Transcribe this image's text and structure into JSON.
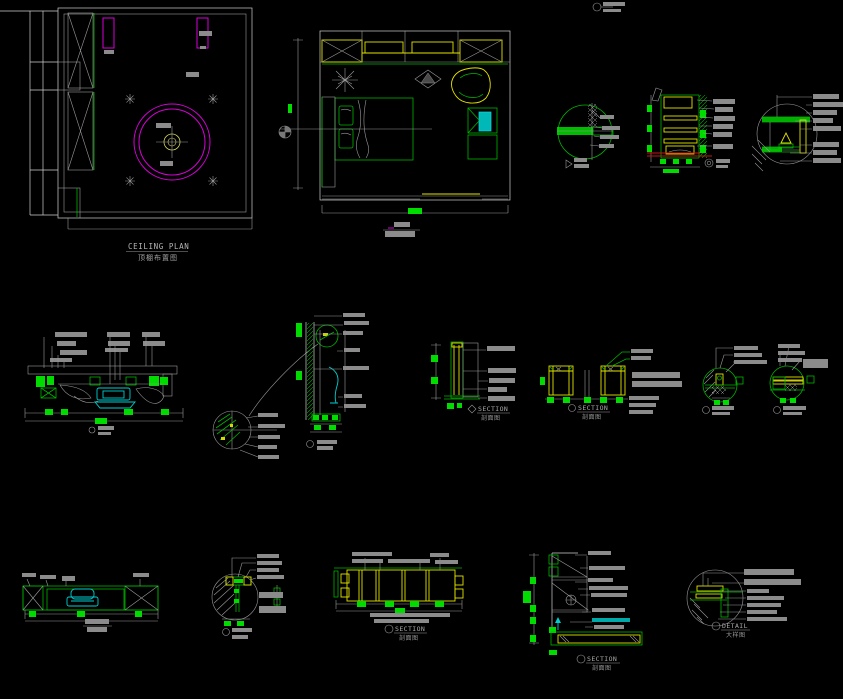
{
  "canvas": {
    "width": 843,
    "height": 699,
    "background": "#000000"
  },
  "palette": {
    "line_white": "#cfcfcf",
    "label_gray": "#8b8b8b",
    "green": "#00b400",
    "bright_green": "#00dc00",
    "yellow": "#e3e300",
    "magenta": "#d800d8",
    "cyan": "#00cfcf",
    "red": "#c81414"
  },
  "titles": {
    "ceiling": {
      "en": "CEILING PLAN",
      "zh": "顶棚布置图"
    },
    "section": {
      "en": "SECTION",
      "zh": "剖面图"
    },
    "detail": {
      "en": "DETAIL",
      "zh": "大样图"
    }
  }
}
